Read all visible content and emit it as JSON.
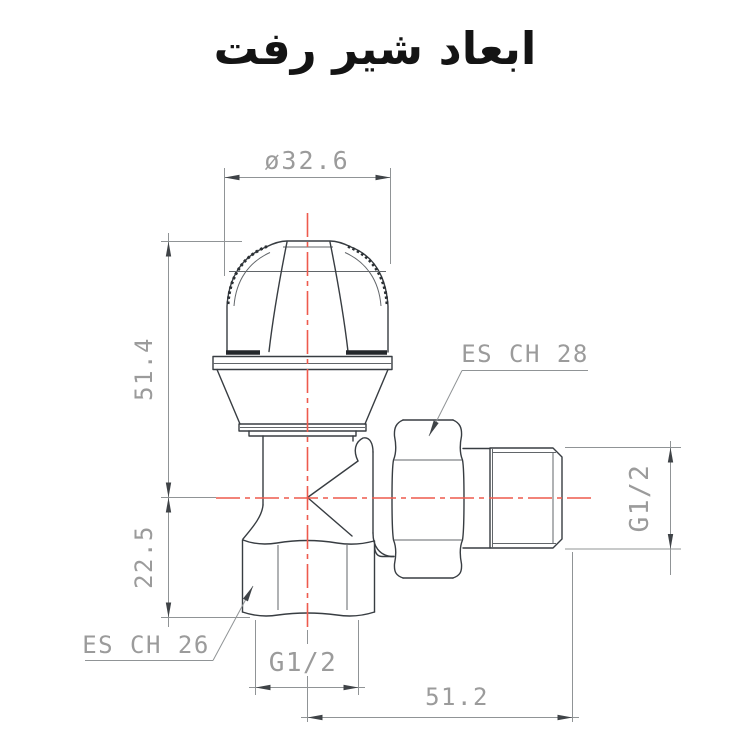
{
  "title": "ابعاد شیر رفت",
  "drawing": {
    "labels": {
      "top_diameter": "ø32.6",
      "height_upper": "51.4",
      "height_lower": "22.5",
      "nut_hex_label": "ES CH 28",
      "body_hex_label": "ES CH 26",
      "side_thread": "G1/2",
      "bottom_thread": "G1/2",
      "side_length": "51.2"
    },
    "colors": {
      "part_line": "#383d42",
      "dimension_line": "#909496",
      "dimension_text": "#9b9b9b",
      "centerline_red": "#ee5a4d",
      "title_text": "#141414",
      "background": "#ffffff"
    }
  }
}
